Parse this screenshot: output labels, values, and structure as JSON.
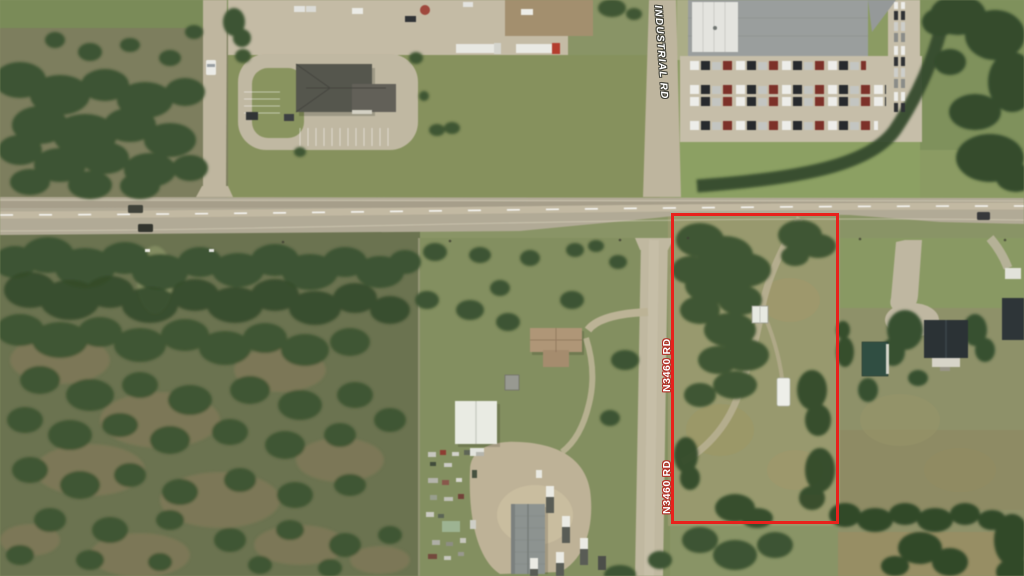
{
  "map": {
    "imagery": "satellite",
    "road_labels": {
      "north_road": "INDUSTRIAL RD",
      "south_road_upper": "N3460 RD",
      "south_road_lower": "N3460 RD"
    },
    "parcel": {
      "outline_color": "#E8211C"
    },
    "label_style": {
      "text_color": "#FFFFFF",
      "north_outline_color": "#45453B",
      "south_outline_color": "#B2342A"
    }
  }
}
